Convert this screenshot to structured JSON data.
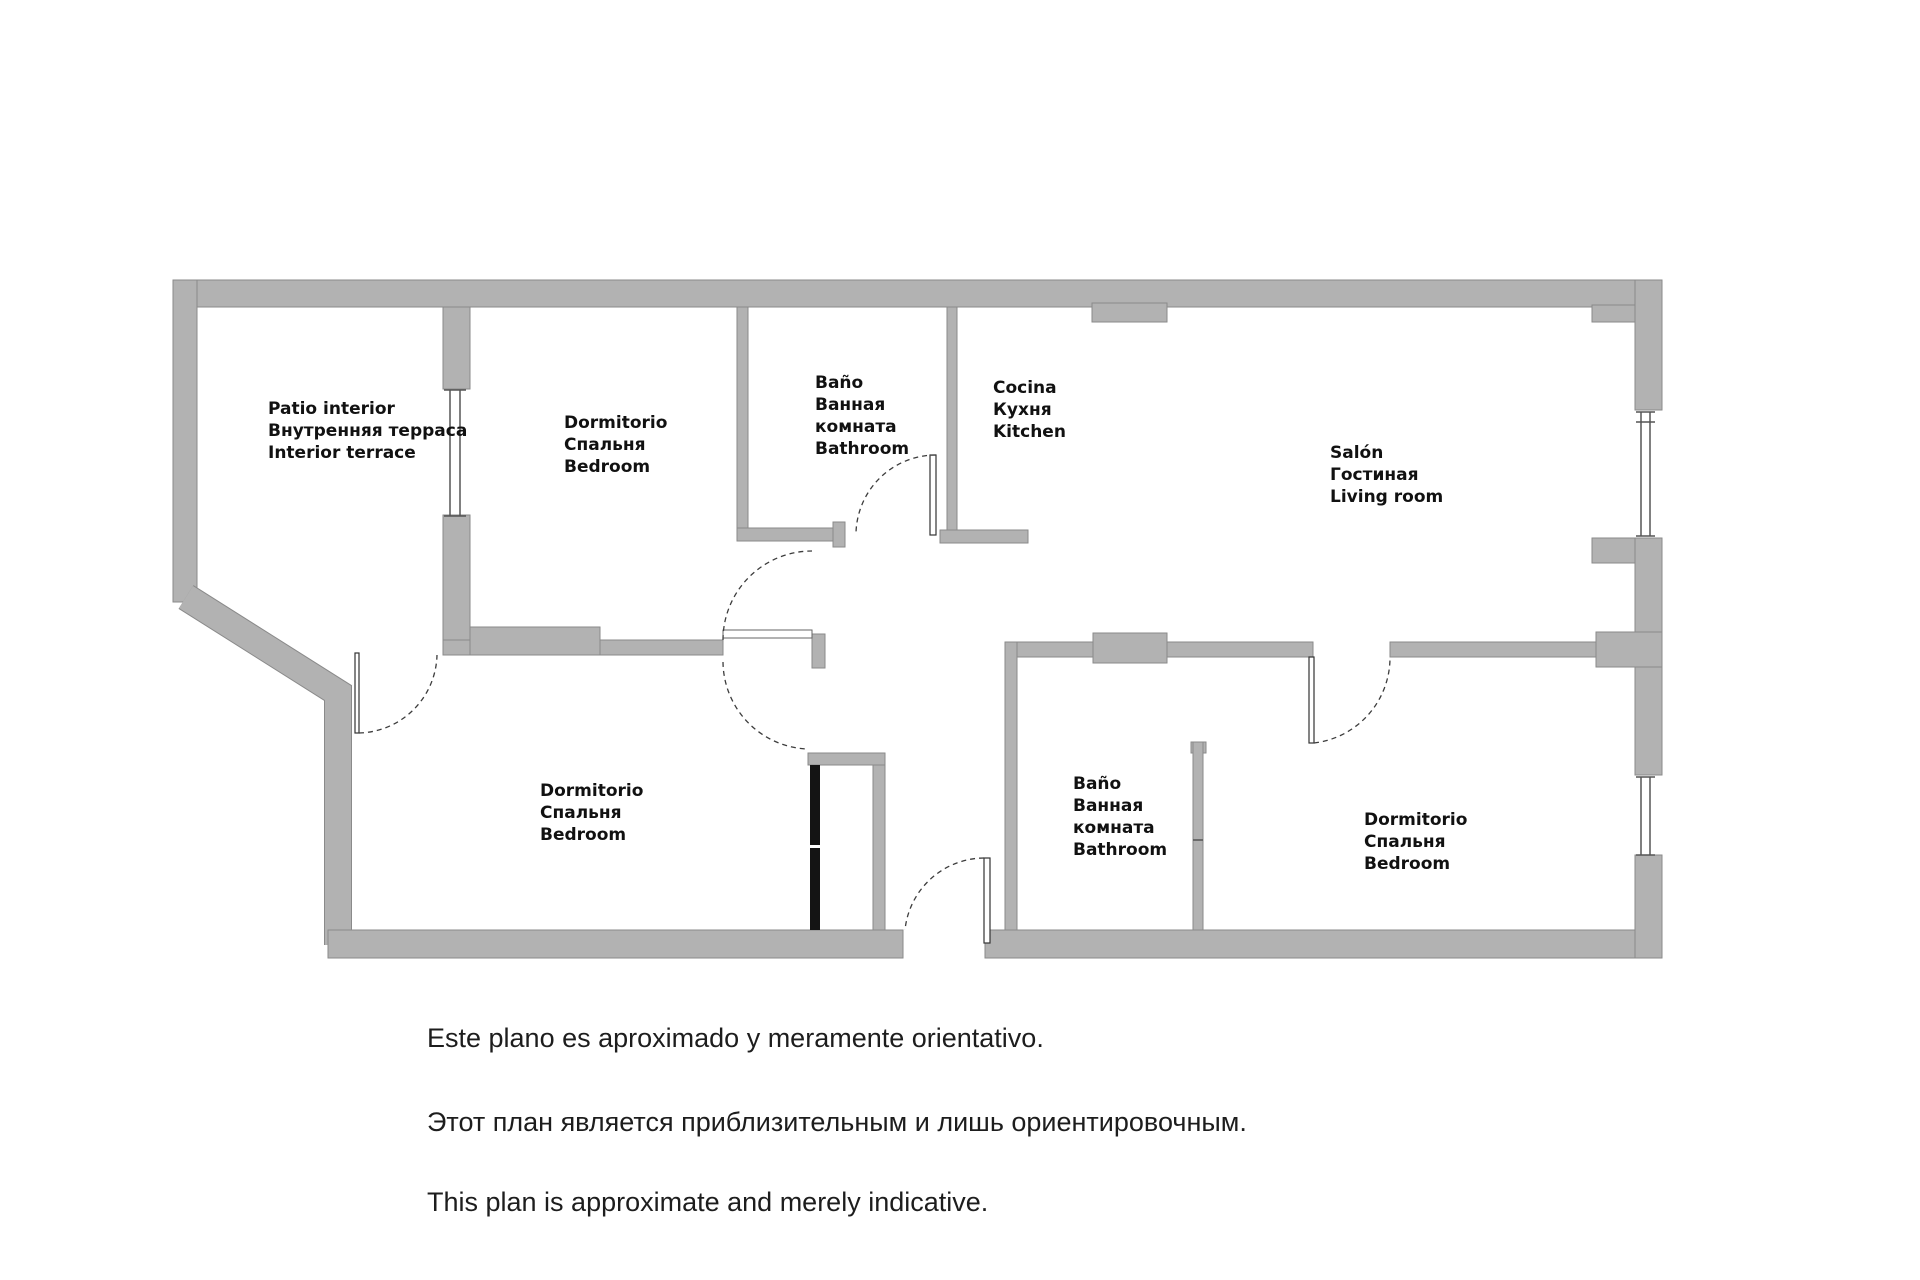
{
  "colors": {
    "wall": "#b2b2b2",
    "wall_edge": "#8a8a8a",
    "shaft": "#141414",
    "text": "#111111",
    "line": "#3c3c3c",
    "win": "#555555"
  },
  "rooms": {
    "patio": {
      "lines": [
        "Patio interior",
        "Внутренняя терраса",
        "Interior terrace"
      ]
    },
    "bedroom1": {
      "lines": [
        "Dormitorio",
        "Спальня",
        "Bedroom"
      ]
    },
    "bathroom1": {
      "lines": [
        "Baño",
        "Ванная",
        "комната",
        "Bathroom"
      ]
    },
    "kitchen": {
      "lines": [
        "Cocina",
        "Кухня",
        "Kitchen"
      ]
    },
    "salon": {
      "lines": [
        "Salón",
        "Гостиная",
        "Living room"
      ]
    },
    "bedroom2": {
      "lines": [
        "Dormitorio",
        "Спальня",
        "Bedroom"
      ]
    },
    "bathroom2": {
      "lines": [
        "Baño",
        "Ванная",
        "комната",
        "Bathroom"
      ]
    },
    "bedroom3": {
      "lines": [
        "Dormitorio",
        "Спальня",
        "Bedroom"
      ]
    }
  },
  "disclaimer": {
    "es": "Este plano es aproximado y meramente orientativo.",
    "ru": "Этот план является приблизительным и лишь ориентировочным.",
    "en": "This plan is approximate and merely indicative."
  }
}
